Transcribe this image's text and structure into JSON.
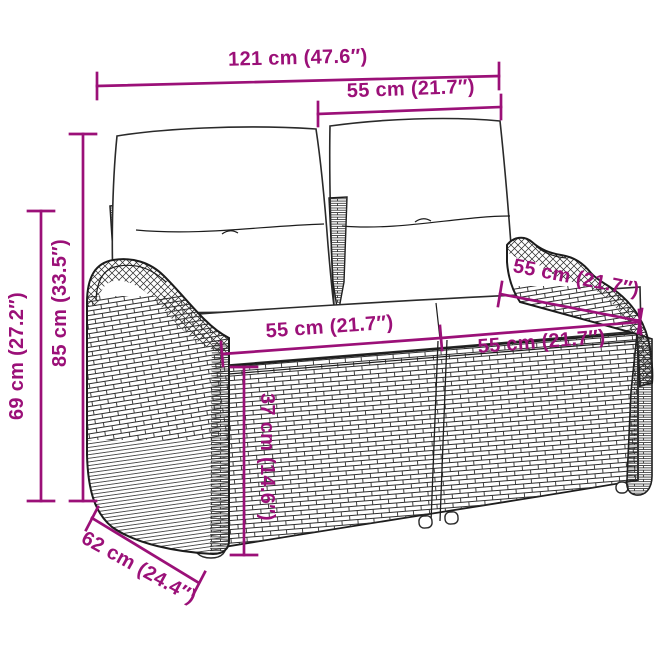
{
  "page": {
    "background": "#ffffff",
    "accent_color": "#9b1078",
    "outline_color": "#1c1c1c",
    "illustration": "poly rattan two-seater garden bench with back cushions and seat cushions"
  },
  "measurements": [
    {
      "id": "total-width",
      "label": "121 cm (47.6″)"
    },
    {
      "id": "back-cushion-width",
      "label": "55 cm (21.7″)"
    },
    {
      "id": "total-height",
      "label": "85 cm (33.5″)"
    },
    {
      "id": "armrest-height",
      "label": "69 cm (27.2″)"
    },
    {
      "id": "seat-width-left",
      "label": "55 cm (21.7″)"
    },
    {
      "id": "seat-width-right",
      "label": "55 cm (21.7″)"
    },
    {
      "id": "seat-depth",
      "label": "55 cm (21.7″)"
    },
    {
      "id": "seat-height",
      "label": "37 cm (14.6″)"
    },
    {
      "id": "total-depth",
      "label": "62 cm (24.4″)"
    }
  ]
}
